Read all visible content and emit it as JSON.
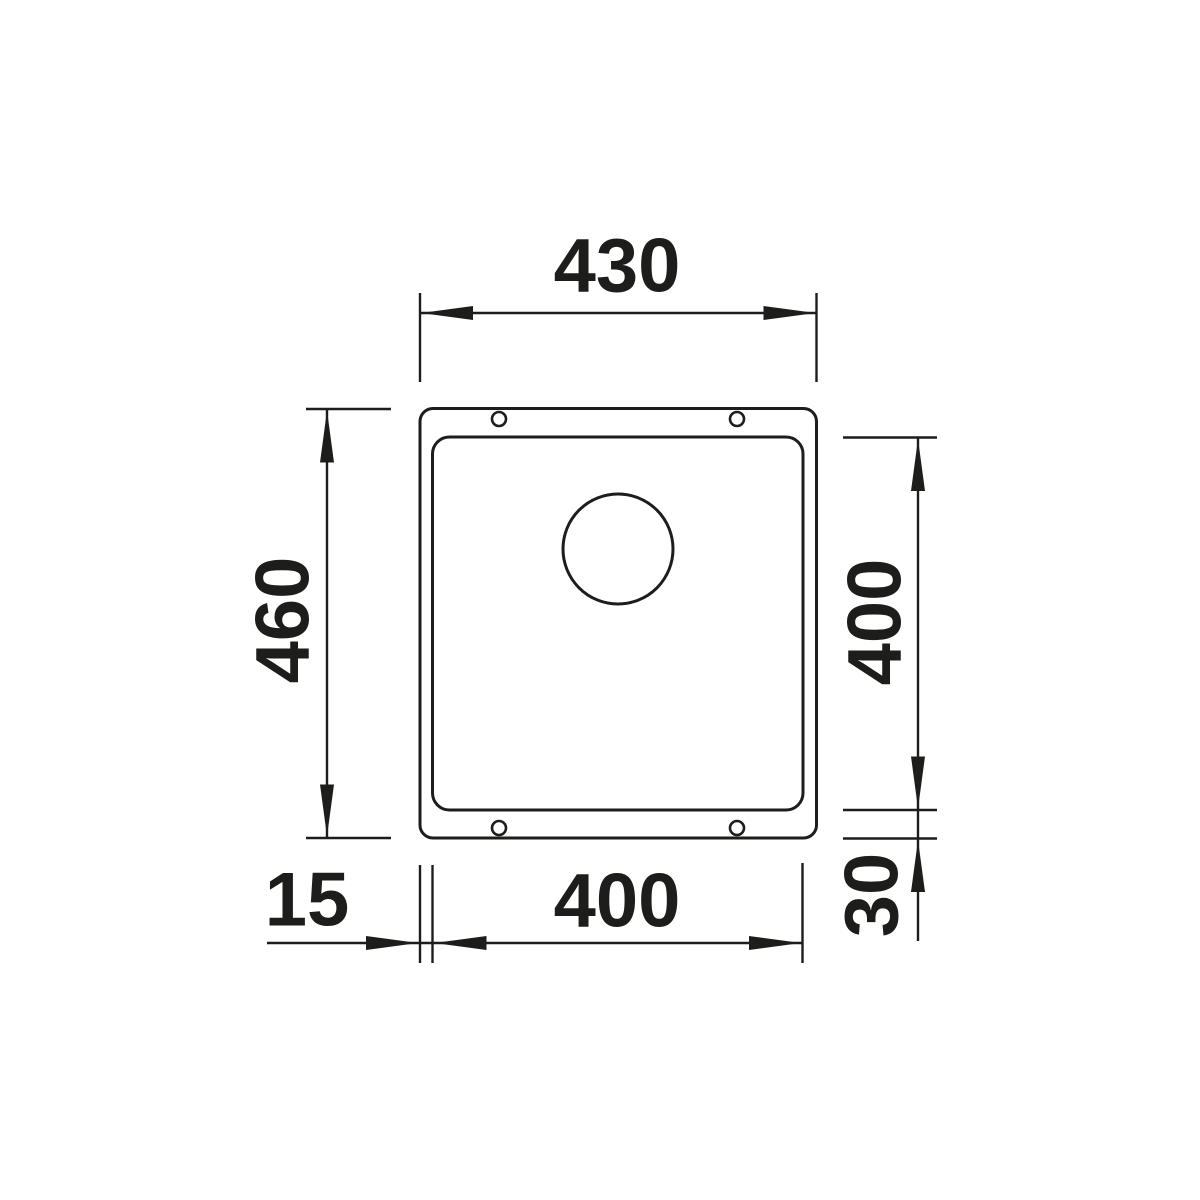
{
  "page": {
    "background": "#ffffff"
  },
  "drawing": {
    "line_color": "#1d1d1b",
    "labels": {
      "top_outer_width": "430",
      "left_outer_height": "460",
      "right_inner_height": "400",
      "right_bottom_rim": "30",
      "bottom_left_rim": "15",
      "bottom_inner_width": "400"
    }
  }
}
